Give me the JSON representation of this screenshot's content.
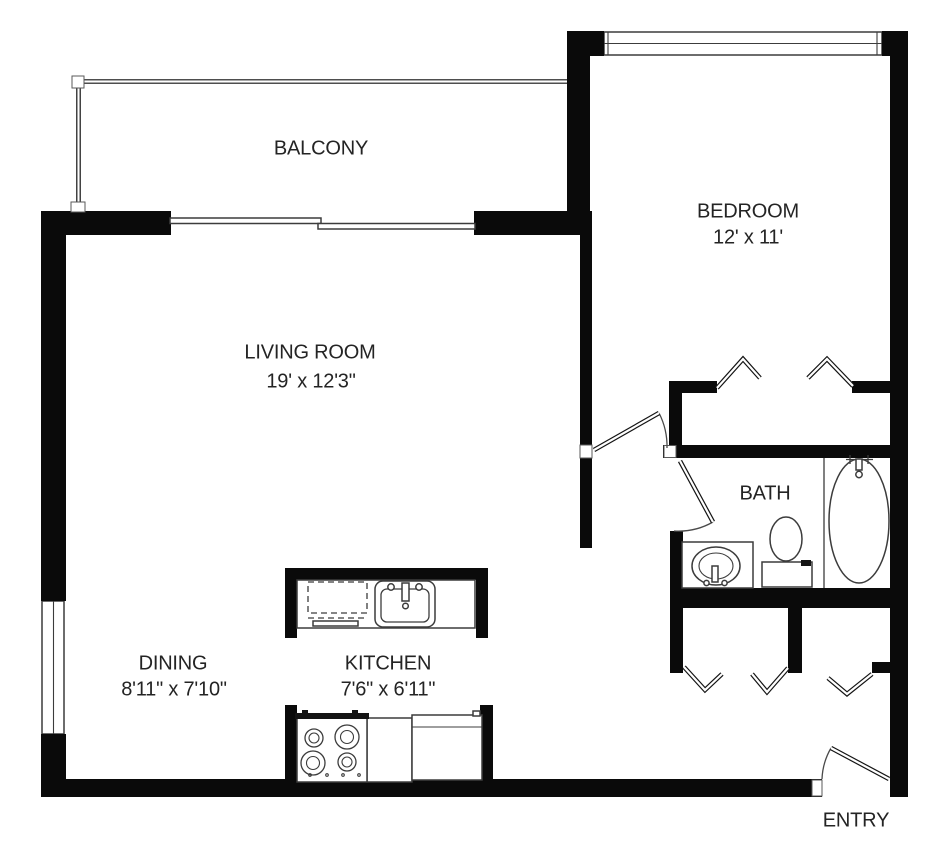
{
  "floor_plan": {
    "rooms": {
      "balcony": {
        "name": "BALCONY"
      },
      "living_room": {
        "name": "LIVING ROOM",
        "dimensions": "19' x 12'3\""
      },
      "bedroom": {
        "name": "BEDROOM",
        "dimensions": "12' x 11'"
      },
      "dining": {
        "name": "DINING",
        "dimensions": "8'11\" x 7'10\""
      },
      "kitchen": {
        "name": "KITCHEN",
        "dimensions": "7'6\" x 6'11\""
      },
      "bath": {
        "name": "BATH"
      },
      "entry": {
        "name": "ENTRY"
      }
    },
    "fixtures": [
      "balcony-railing",
      "sliding-glass-door",
      "living-room-window",
      "bedroom-window",
      "bedroom-door",
      "bedroom-closet-bifold-doors",
      "bath-door",
      "bathtub",
      "toilet",
      "vanity-sink",
      "hall-closet-bifold-doors",
      "kitchen-sink",
      "dishwasher",
      "stove",
      "refrigerator",
      "entry-door"
    ],
    "colors": {
      "wall": "#0a0a0a",
      "line": "#3c3c3c",
      "text": "#242424",
      "background": "#ffffff"
    }
  }
}
